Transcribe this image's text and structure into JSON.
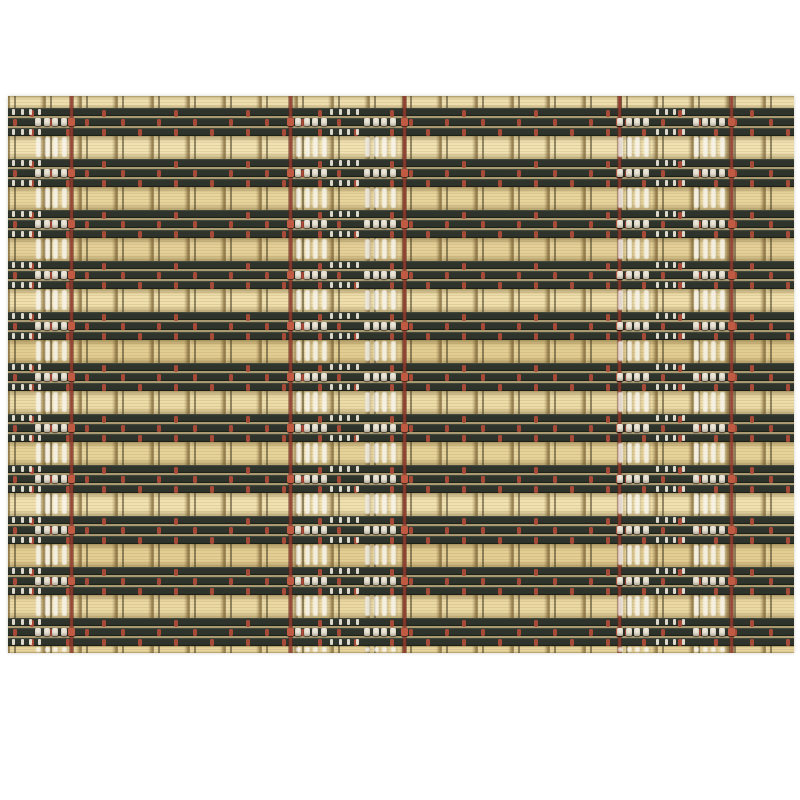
{
  "scene": {
    "type": "product-photo",
    "description": "Woven bamboo placemat: horizontal natural tan bamboo slats alternating with bands of three dark olive-black slats, fine dark warp threads, dark-red accent warp threads, red stitch dots and clusters of white thread stitching, centered on a plain white background",
    "background_color": "#ffffff"
  },
  "mat": {
    "left": 8,
    "top": 96,
    "width": 786,
    "height": 557,
    "rows": 11,
    "row_period": 51,
    "first_band_top": 12,
    "dark_band_height": 28,
    "tan_band_height": 23,
    "bottom_sliver_height": 7,
    "warp_spacing": 36,
    "warp_offset": 6,
    "red_thread_xs": [
      61,
      280,
      394,
      609,
      721
    ],
    "red_thread_width": 5,
    "white_column_xs": [
      25,
      285,
      354,
      607,
      683
    ],
    "white_column_width": 36,
    "tick_group_xs": [
      4,
      322,
      648
    ],
    "tan_shades": [
      "#eedfaf",
      "#f0e2b2",
      "#e7d59d",
      "#e4d098",
      "#eedfac",
      "#e2cd92",
      "#ecdca8",
      "#e6d39a",
      "#f0e1b0",
      "#e3ce94",
      "#ebd9a4",
      "#e8d59e"
    ],
    "colors": {
      "tan_base": "#e9d8a2",
      "slat_dark": "#2e332b",
      "slat_highlight": "#4d5243",
      "slat_shadow": "#15180f",
      "slat_gap": "#a99a72",
      "warp_line": "rgba(55,48,28,0.5)",
      "red_thread": "#8f3a2c",
      "red_bright": "#c05a42",
      "red_dot": "#b24c3a",
      "white_thread": "#ece7da",
      "tuft_white": "rgba(248,245,238,0.82)"
    }
  }
}
